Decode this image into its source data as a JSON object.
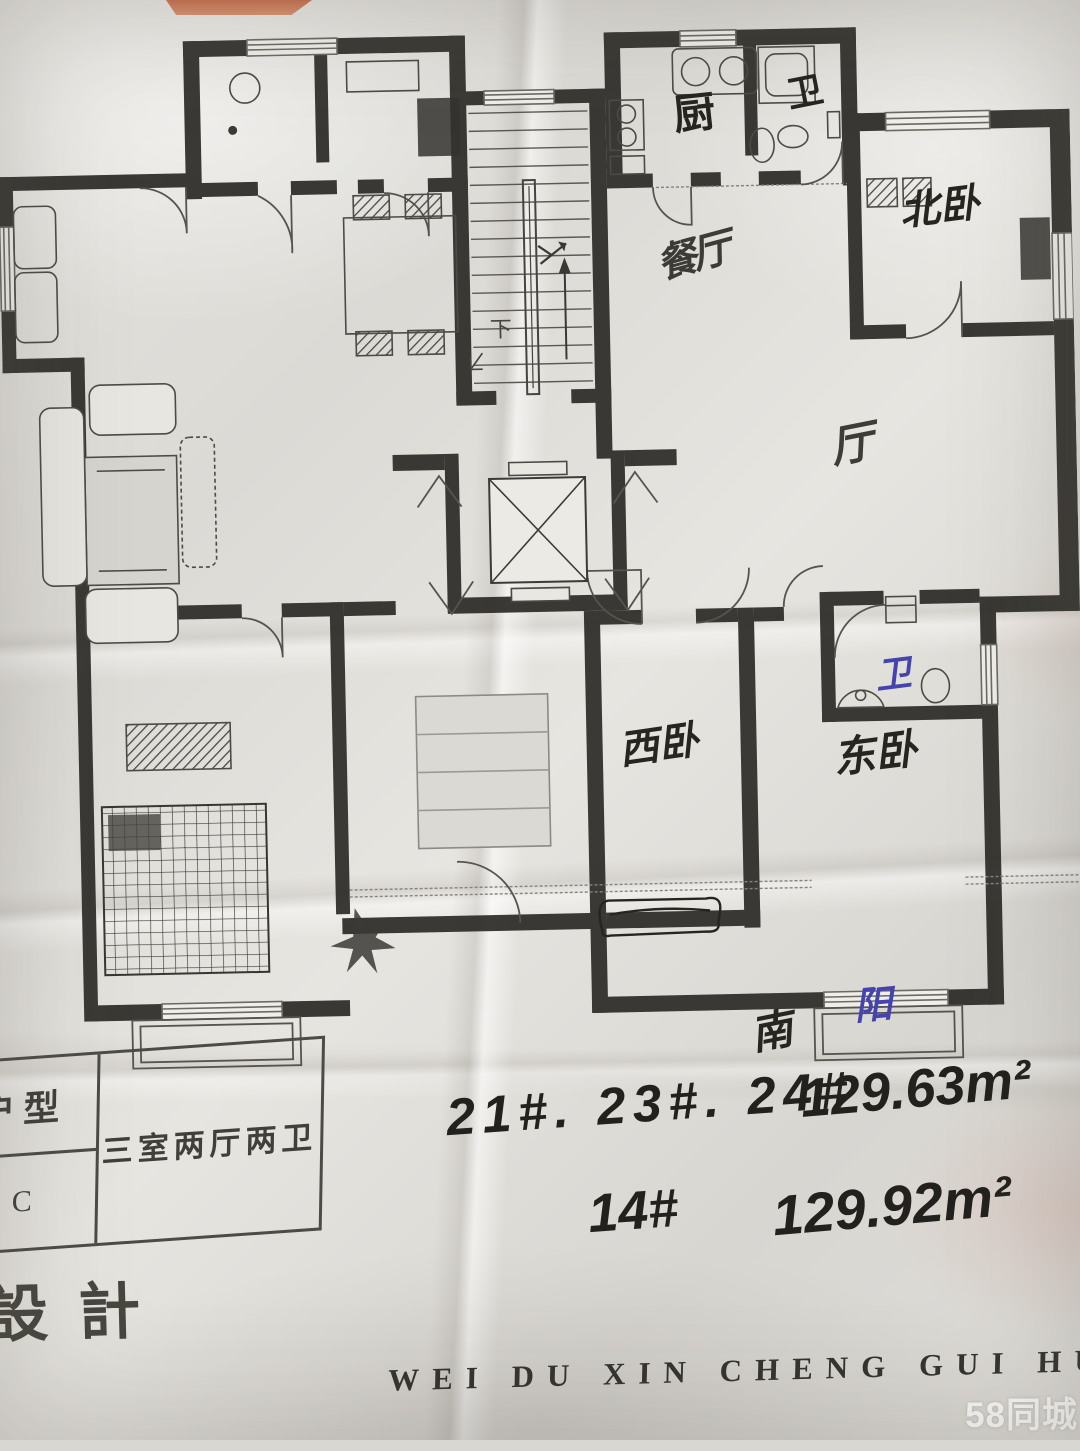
{
  "photo": {
    "watermark": "58同城",
    "pinyin_caption": "WEI DU XIN CHENG GUI HUA"
  },
  "title_block": {
    "unit_type_label": "户型",
    "unit_code": "C",
    "layout_desc": "三室两厅两卫",
    "design_label": "設計"
  },
  "plan_labels": {
    "kitchen": "厨",
    "bath_top": "卫",
    "dining_handwritten": "餐厅",
    "north_bedroom": "北卧",
    "hall_handwritten": "厅",
    "west_bedroom": "西卧",
    "east_bedroom": "东卧",
    "bath_blue": "卫",
    "balcony_blue": "阳",
    "south": "南",
    "stairs_down": "下"
  },
  "handwritten_notes": {
    "line1_buildings": "21#. 23#. 24#",
    "line1_area": "129.63m²",
    "line2_building": "14#",
    "line2_area": "129.92m²"
  },
  "colors": {
    "wall_ink": "#2f2e2a",
    "black_pen": "#22211d",
    "blue_pen": "#4543ad"
  }
}
